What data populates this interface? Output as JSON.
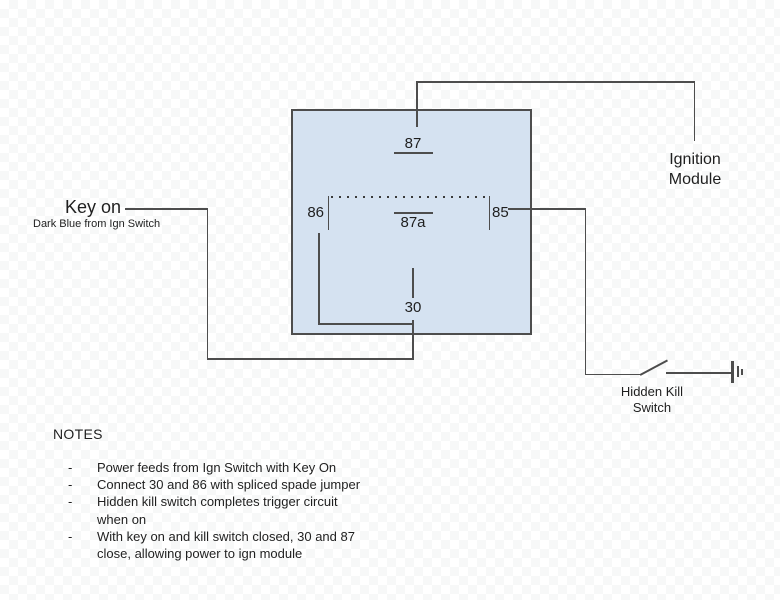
{
  "diagram": {
    "relay": {
      "terminal_87": "87",
      "terminal_87a": "87a",
      "terminal_86": "86",
      "terminal_85": "85",
      "terminal_30": "30"
    },
    "key_on": {
      "title": "Key on",
      "subtitle": "Dark Blue from Ign Switch"
    },
    "ignition_module": {
      "line1": "Ignition",
      "line2": "Module"
    },
    "kill_switch": {
      "line1": "Hidden Kill",
      "line2": "Switch"
    }
  },
  "notes": {
    "heading": "NOTES",
    "bullet": "-",
    "items": [
      {
        "line1": "Power feeds from Ign Switch with Key On",
        "line2": ""
      },
      {
        "line1": "Connect 30 and 86 with spliced spade jumper",
        "line2": ""
      },
      {
        "line1": "Hidden kill switch completes trigger circuit",
        "line2": "when on"
      },
      {
        "line1": "With key on and kill switch closed, 30 and 87",
        "line2": "close, allowing power to ign module"
      }
    ]
  },
  "colors": {
    "relay_fill": "#d5e2f1",
    "wire": "#4d4d4d",
    "checker_gray": "#f7f8f8",
    "text": "#1f1f1f"
  }
}
